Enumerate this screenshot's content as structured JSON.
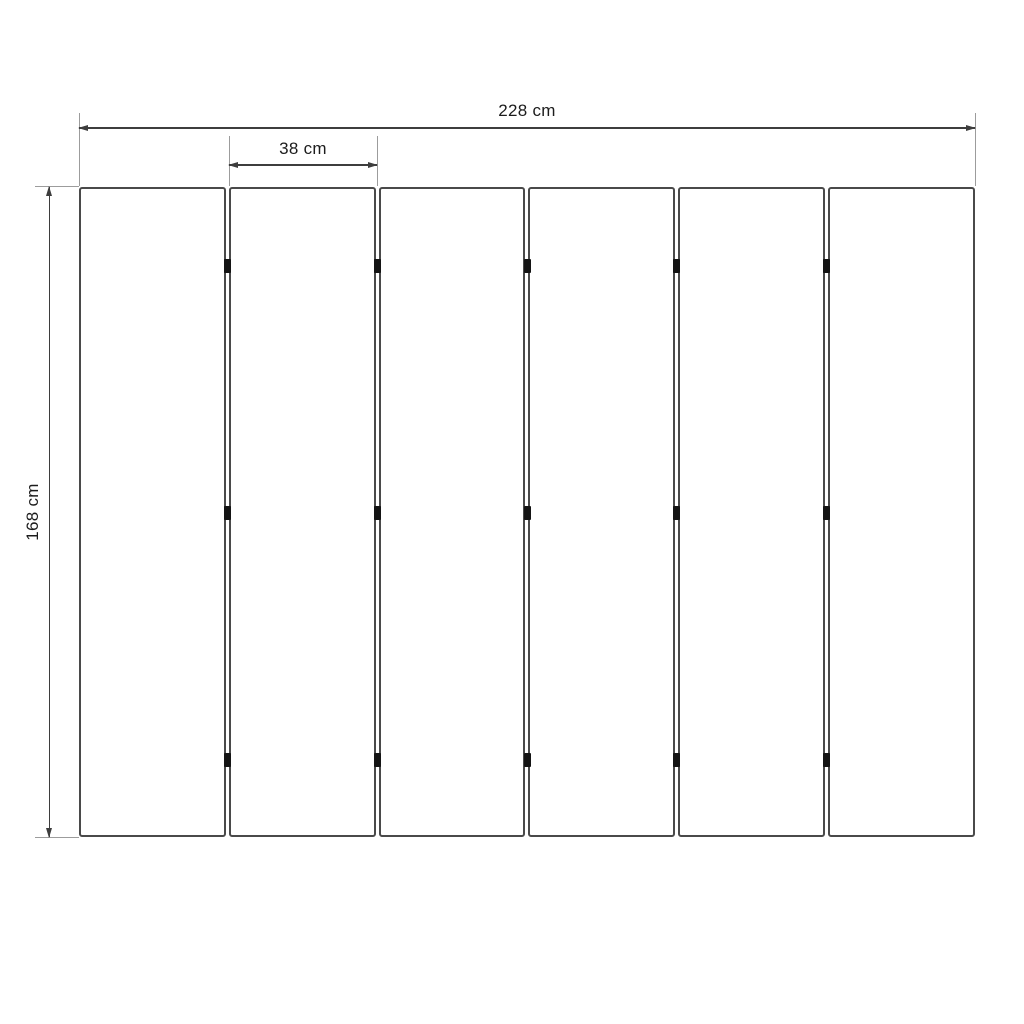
{
  "diagram": {
    "panel_count": 6,
    "hinge_rows": 3,
    "dimensions": {
      "total_width": "228 cm",
      "single_panel_width": "38 cm",
      "height": "168 cm"
    },
    "colors": {
      "background": "#ffffff",
      "dimension_line": "#3d3d3d",
      "extension_line": "#9c9c9c",
      "panel_border": "#4a4a4a",
      "hinge": "#141414",
      "label_text": "#1c1c1c"
    }
  }
}
